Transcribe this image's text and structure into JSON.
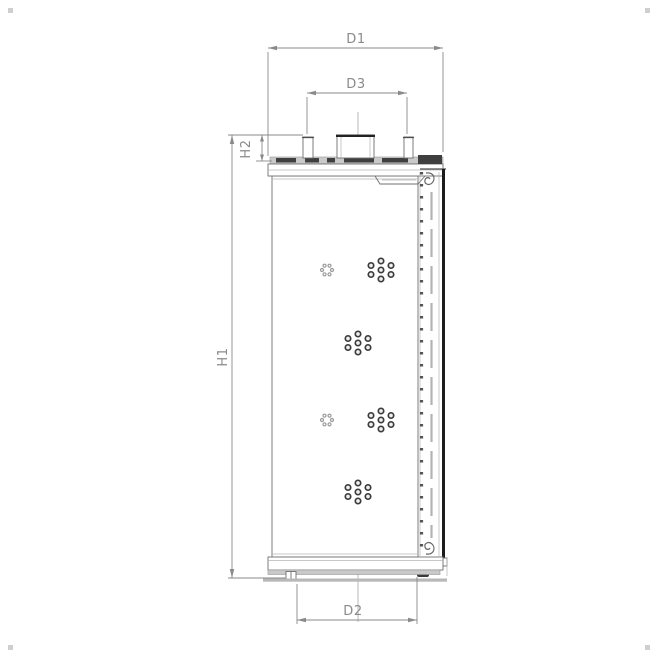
{
  "drawing": {
    "type": "technical-section-drawing",
    "subject": "filter-element",
    "labels": {
      "d1": "D1",
      "d3": "D3",
      "d2": "D2",
      "h1": "H1",
      "h2": "H2"
    },
    "perforation_clusters": [
      {
        "x": 327,
        "y": 270,
        "style": "light"
      },
      {
        "x": 381,
        "y": 270,
        "style": "dark"
      },
      {
        "x": 358,
        "y": 343,
        "style": "dark"
      },
      {
        "x": 327,
        "y": 420,
        "style": "light"
      },
      {
        "x": 381,
        "y": 420,
        "style": "dark"
      },
      {
        "x": 358,
        "y": 492,
        "style": "dark"
      }
    ],
    "colors": {
      "dimension": "#8a8a8a",
      "outline": "#6f6f6f",
      "thick_edge": "#1c1c1c",
      "gray_fill": "#c9c9c9",
      "dark_fill": "#3f3f3f",
      "background": "#ffffff"
    }
  }
}
